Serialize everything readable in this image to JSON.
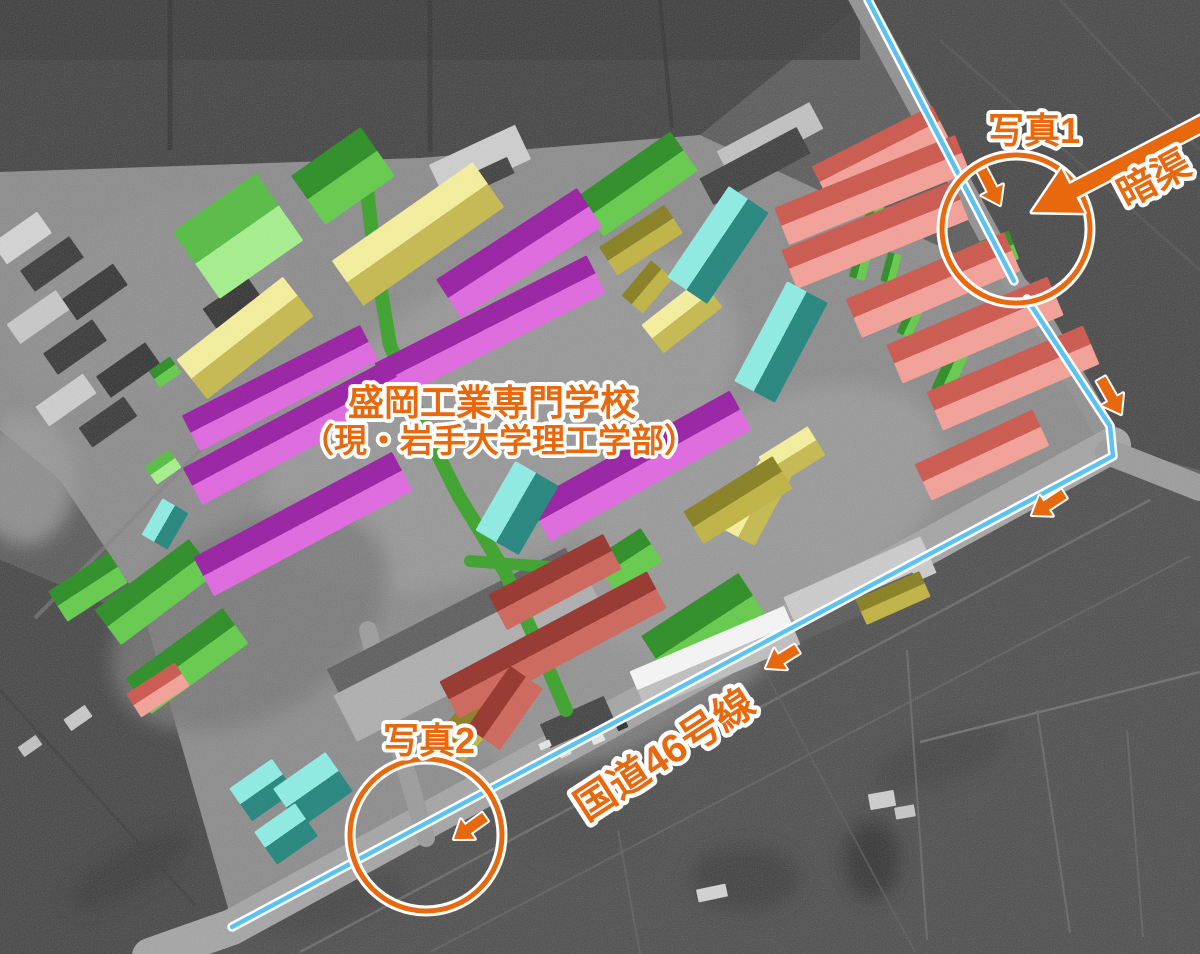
{
  "canvas": {
    "width": 1200,
    "height": 954
  },
  "colors": {
    "annotation_orange": "#E8680D",
    "route_line_blue": "#5CC3F0",
    "outline_white": "#FFFFFF",
    "corridor_green": "#3FA32F",
    "building_palette": {
      "magenta": {
        "a": "#9A22A4",
        "b": "#DF6ADF"
      },
      "salmon": {
        "a": "#CC5A50",
        "b": "#F3A198"
      },
      "red": {
        "a": "#97372F",
        "b": "#CE685D"
      },
      "yellow": {
        "a": "#F4EF9D",
        "b": "#C6BA52"
      },
      "olive": {
        "a": "#8A8124",
        "b": "#C0B446"
      },
      "green": {
        "a": "#2F8F28",
        "b": "#66CB4E"
      },
      "lightgreen": {
        "a": "#59BD47",
        "b": "#A6EF8E"
      },
      "teal": {
        "a": "#8FECE4",
        "b": "#27877F"
      },
      "whitebldg": {
        "a": "#F5F5F5",
        "b": "#BFBFBF"
      }
    }
  },
  "labels": [
    {
      "name": "label-school-title-line1",
      "text": "盛岡工業専門学校",
      "x": 492,
      "y": 415,
      "size": 36,
      "rot": 0
    },
    {
      "name": "label-school-title-line2",
      "text": "（現・岩手大学理工学部）",
      "x": 499,
      "y": 452,
      "size": 33,
      "rot": 0
    },
    {
      "name": "label-photo1",
      "text": "写真1",
      "x": 1034,
      "y": 143,
      "size": 36,
      "rot": 0
    },
    {
      "name": "label-photo2",
      "text": "写真2",
      "x": 429,
      "y": 753,
      "size": 36,
      "rot": 0
    },
    {
      "name": "label-culvert",
      "text": "暗渠",
      "x": 1160,
      "y": 190,
      "size": 38,
      "rot": -28
    },
    {
      "name": "label-route46",
      "text": "国道46号線",
      "x": 672,
      "y": 766,
      "size": 40,
      "rot": -33
    }
  ],
  "building_fields_order": [
    "cx",
    "cy",
    "length",
    "width",
    "rotation_deg",
    "color"
  ],
  "buildings": [
    [
      238,
      236,
      102,
      82,
      -35,
      "lightgreen"
    ],
    [
      163,
      467,
      30,
      22,
      -35,
      "lightgreen"
    ],
    [
      343,
      176,
      85,
      60,
      -35,
      "green"
    ],
    [
      637,
      184,
      115,
      48,
      -35,
      "green"
    ],
    [
      88,
      587,
      72,
      36,
      -33,
      "green"
    ],
    [
      155,
      592,
      118,
      44,
      -37,
      "green"
    ],
    [
      187,
      661,
      120,
      44,
      -36,
      "green"
    ],
    [
      705,
      628,
      116,
      56,
      -33,
      "green"
    ],
    [
      628,
      560,
      56,
      40,
      -33,
      "green"
    ],
    [
      165,
      372,
      26,
      20,
      -35,
      "green"
    ],
    [
      997,
      251,
      36,
      30,
      -20,
      "green"
    ],
    [
      867,
      240,
      80,
      16,
      -75,
      "green"
    ],
    [
      891,
      268,
      30,
      14,
      -75,
      "green"
    ],
    [
      911,
      319,
      36,
      15,
      -65,
      "green"
    ],
    [
      950,
      372,
      46,
      20,
      -65,
      "green"
    ],
    [
      418,
      234,
      172,
      55,
      -35,
      "yellow"
    ],
    [
      245,
      338,
      135,
      50,
      -38,
      "yellow"
    ],
    [
      792,
      456,
      58,
      34,
      -32,
      "yellow"
    ],
    [
      757,
      503,
      78,
      36,
      -62,
      "yellow"
    ],
    [
      682,
      316,
      75,
      36,
      -38,
      "yellow"
    ],
    [
      641,
      240,
      78,
      34,
      -33,
      "olive"
    ],
    [
      647,
      287,
      46,
      28,
      -50,
      "olive"
    ],
    [
      738,
      500,
      105,
      38,
      -32,
      "olive"
    ],
    [
      470,
      725,
      65,
      38,
      -50,
      "olive"
    ],
    [
      893,
      598,
      70,
      28,
      -24,
      "olive"
    ],
    [
      519,
      253,
      168,
      46,
      -33,
      "magenta"
    ],
    [
      490,
      328,
      238,
      42,
      -27,
      "magenta"
    ],
    [
      280,
      388,
      200,
      40,
      -27,
      "magenta"
    ],
    [
      295,
      432,
      232,
      42,
      -28,
      "magenta"
    ],
    [
      303,
      524,
      225,
      44,
      -28,
      "magenta"
    ],
    [
      640,
      466,
      230,
      45,
      -29,
      "magenta"
    ],
    [
      880,
      152,
      135,
      36,
      -27,
      "salmon"
    ],
    [
      872,
      190,
      195,
      40,
      -22,
      "salmon"
    ],
    [
      875,
      235,
      185,
      42,
      -22,
      "salmon"
    ],
    [
      933,
      285,
      172,
      42,
      -23,
      "salmon"
    ],
    [
      975,
      330,
      175,
      42,
      -23,
      "salmon"
    ],
    [
      1013,
      378,
      170,
      42,
      -23,
      "salmon"
    ],
    [
      982,
      455,
      130,
      40,
      -25,
      "salmon"
    ],
    [
      158,
      690,
      58,
      28,
      -33,
      "salmon"
    ],
    [
      555,
      582,
      130,
      40,
      -28,
      "red"
    ],
    [
      553,
      645,
      235,
      42,
      -28,
      "red"
    ],
    [
      505,
      708,
      75,
      40,
      -55,
      "red"
    ],
    [
      718,
      245,
      110,
      48,
      -56,
      "teal"
    ],
    [
      781,
      342,
      113,
      46,
      -62,
      "teal"
    ],
    [
      517,
      508,
      80,
      50,
      -60,
      "teal"
    ],
    [
      165,
      524,
      42,
      30,
      -60,
      "teal"
    ],
    [
      262,
      790,
      52,
      40,
      -35,
      "teal"
    ],
    [
      313,
      790,
      64,
      48,
      -35,
      "teal"
    ],
    [
      286,
      834,
      50,
      40,
      -35,
      "teal"
    ],
    [
      715,
      658,
      168,
      42,
      -23,
      "whitebldg"
    ]
  ],
  "gray_buildings": [
    [
      22,
      238,
      55,
      26,
      -35,
      "#d6d6d6"
    ],
    [
      52,
      264,
      60,
      26,
      -35,
      "#343434"
    ],
    [
      95,
      292,
      62,
      26,
      -35,
      "#303030"
    ],
    [
      38,
      317,
      60,
      24,
      -35,
      "#c9c9c9"
    ],
    [
      75,
      347,
      60,
      26,
      -35,
      "#323232"
    ],
    [
      128,
      370,
      60,
      26,
      -35,
      "#2f2f2f"
    ],
    [
      66,
      400,
      58,
      24,
      -35,
      "#cfcfcf"
    ],
    [
      108,
      422,
      55,
      24,
      -35,
      "#353535"
    ],
    [
      232,
      303,
      55,
      24,
      -35,
      "#2e2e2e"
    ],
    [
      264,
      333,
      55,
      24,
      -35,
      "#313131"
    ],
    [
      480,
      162,
      95,
      38,
      -25,
      "#d0d0d0"
    ],
    [
      470,
      184,
      90,
      18,
      -25,
      "#3a3a3a"
    ],
    [
      770,
      140,
      105,
      30,
      -28,
      "#c2c2c2"
    ],
    [
      755,
      166,
      110,
      30,
      -28,
      "#3a3a3a"
    ],
    [
      470,
      655,
      280,
      52,
      -27,
      "#aeaeae"
    ],
    [
      452,
      620,
      268,
      26,
      -27,
      "#595959"
    ],
    [
      860,
      585,
      150,
      40,
      -24,
      "#cdcdcd"
    ],
    [
      850,
      610,
      145,
      18,
      -24,
      "#565656"
    ],
    [
      577,
      722,
      70,
      26,
      -24,
      "#3d3d3d"
    ],
    [
      545,
      745,
      12,
      7,
      -24,
      "#e8e8e8"
    ],
    [
      565,
      753,
      12,
      7,
      -24,
      "#e2e2e2"
    ],
    [
      598,
      739,
      13,
      8,
      -24,
      "#ececec"
    ],
    [
      622,
      726,
      11,
      7,
      -24,
      "#262626"
    ],
    [
      712,
      893,
      30,
      13,
      -12,
      "#d5d5d5"
    ],
    [
      78,
      718,
      26,
      14,
      -35,
      "#c9c9c9"
    ],
    [
      30,
      746,
      22,
      12,
      -35,
      "#c2c2c2"
    ],
    [
      882,
      800,
      26,
      16,
      -10,
      "#cfcfcf"
    ],
    [
      905,
      812,
      20,
      12,
      -10,
      "#c7c7c7"
    ]
  ],
  "terrain": {
    "polygons": [
      {
        "points": "0,0 866,0 700,135 420,158 0,172",
        "fill": "#3f3f3f"
      },
      {
        "points": "866,0 1200,0 1200,470 1118,448 1032,300 1018,282",
        "fill": "#444444"
      },
      {
        "points": "1113,462 1200,500 1200,954 158,954 232,922",
        "fill": "#4b4b4b"
      },
      {
        "points": "0,560 205,645 232,922 158,954 0,954",
        "fill": "#424242"
      },
      {
        "points": "0,172 420,158 700,135 1016,282 1030,300 1113,450 560,755 426,840 232,922 140,600 60,480 0,430",
        "fill": "#8a8a8a"
      }
    ],
    "top_strip": {
      "x": 0,
      "y": 0,
      "w": 860,
      "h": 60,
      "fill": "#383838",
      "op": 0.85
    },
    "patches": [
      [
        500,
        420,
        260,
        140,
        -28,
        "#999999",
        0.85
      ],
      [
        760,
        520,
        200,
        110,
        -28,
        "#9e9e9e",
        0.7
      ],
      [
        250,
        620,
        150,
        95,
        -30,
        "#747474",
        0.8
      ],
      [
        150,
        300,
        150,
        90,
        -30,
        "#8f8f8f",
        0.6
      ],
      [
        640,
        660,
        180,
        80,
        -28,
        "#979797",
        0.6
      ],
      [
        25,
        480,
        50,
        65,
        0,
        "#9a9a9a",
        0.8
      ],
      [
        745,
        878,
        55,
        33,
        0,
        "#3a3a3a",
        0.9
      ],
      [
        590,
        838,
        60,
        28,
        0,
        "#464646",
        0.8
      ],
      [
        940,
        758,
        70,
        26,
        -20,
        "#3e3e3e",
        0.7
      ],
      [
        330,
        905,
        80,
        24,
        -15,
        "#3c3c3c",
        0.6
      ],
      [
        130,
        870,
        70,
        22,
        -30,
        "#333333",
        0.6
      ],
      [
        872,
        860,
        28,
        40,
        0,
        "#2e2e2e",
        0.9
      ]
    ],
    "lines": [
      [
        170,
        0,
        170,
        150,
        "#2d2d2d",
        5,
        0.8
      ],
      [
        430,
        0,
        430,
        152,
        "#2d2d2d",
        5,
        0.7
      ],
      [
        660,
        0,
        672,
        128,
        "#2d2d2d",
        4,
        0.7
      ],
      [
        940,
        40,
        1200,
        270,
        "#515151",
        3,
        0.8
      ],
      [
        1060,
        0,
        1200,
        150,
        "#515151",
        3,
        0.8
      ],
      [
        300,
        952,
        1150,
        500,
        "#6a6a6a",
        2.5,
        0.9
      ],
      [
        430,
        952,
        1190,
        556,
        "#5f5f5f",
        2,
        0.8
      ],
      [
        920,
        742,
        1200,
        672,
        "#6f6f6f",
        2.5,
        0.9
      ],
      [
        907,
        650,
        927,
        940,
        "#666666",
        2,
        0.9
      ],
      [
        1037,
        710,
        1070,
        933,
        "#666666",
        2,
        0.9
      ],
      [
        1127,
        730,
        1143,
        937,
        "#606060",
        2,
        0.9
      ],
      [
        618,
        830,
        640,
        954,
        "#5d5d5d",
        2,
        0.8
      ],
      [
        760,
        662,
        915,
        952,
        "#5a5a5a",
        2,
        0.7
      ],
      [
        0,
        690,
        195,
        905,
        "#383838",
        3,
        0.8
      ],
      [
        35,
        618,
        225,
        425,
        "#7d7d7d",
        4,
        0.6
      ]
    ]
  },
  "roads": [
    {
      "pts": [
        [
          858,
          -5
        ],
        [
          1016,
          285
        ],
        [
          1030,
          300
        ],
        [
          1113,
          445
        ]
      ],
      "w": 22,
      "c": "#8f8f8f"
    },
    {
      "pts": [
        [
          1113,
          445
        ],
        [
          232,
          927
        ],
        [
          150,
          956
        ]
      ],
      "w": 36,
      "c": "#a4a4a4"
    },
    {
      "pts": [
        [
          1108,
          452
        ],
        [
          1200,
          488
        ]
      ],
      "w": 26,
      "c": "#9a9a9a"
    },
    {
      "pts": [
        [
          426,
          838
        ],
        [
          382,
          688
        ],
        [
          368,
          630
        ]
      ],
      "w": 18,
      "c": "#9a9a9a"
    }
  ],
  "green_corridor": {
    "main": "M362,148 L374,250 L390,345 L423,425 L458,495 L505,572 L540,650 L566,710",
    "branch": "M470,561 L575,569",
    "main_w": 14,
    "branch_w": 12
  },
  "blue_route": {
    "d": "M868,0 L1014,281 M1027,299 L1110,426 L1113,456 L232,927",
    "w": 4.5,
    "outline_w": 9.5
  },
  "circles": [
    {
      "name": "photo1-circle-marker",
      "cx": 1016,
      "cy": 229,
      "r": 74
    },
    {
      "name": "photo2-circle-marker",
      "cx": 426,
      "cy": 835,
      "r": 76
    }
  ],
  "arrows": [
    {
      "tail": [
        982,
        170
      ],
      "tip": [
        1000,
        205
      ]
    },
    {
      "tail": [
        1101,
        379
      ],
      "tip": [
        1121,
        414
      ]
    },
    {
      "tail": [
        1064,
        494
      ],
      "tip": [
        1032,
        515
      ]
    },
    {
      "tail": [
        797,
        649
      ],
      "tip": [
        766,
        668
      ]
    },
    {
      "tail": [
        485,
        817
      ],
      "tip": [
        454,
        839
      ]
    }
  ],
  "big_arrow": {
    "tail": [
      1205,
      122
    ],
    "tip": [
      1032,
      212
    ],
    "shaft_hw": 7.5,
    "head_len": 46,
    "head_hw": 25
  }
}
